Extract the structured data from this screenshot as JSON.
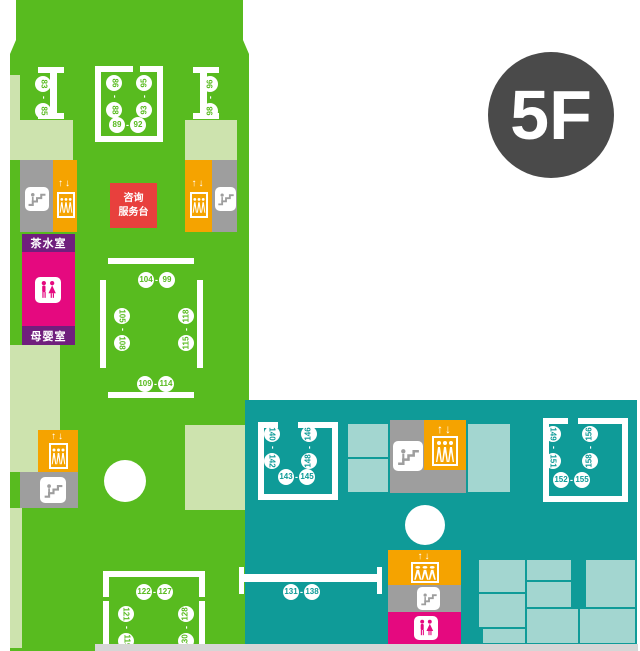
{
  "floor": {
    "badge": "5F"
  },
  "sep": "-",
  "elevator_arrows": "↑↓",
  "info_desk": {
    "line1": "咨询",
    "line2": "服务台"
  },
  "rooms": {
    "tea_room": "茶水室",
    "nursing_room": "母婴室"
  },
  "gates": {
    "pillar_left": {
      "a": "83",
      "b": "85"
    },
    "center_left": {
      "a": "86",
      "b": "88"
    },
    "center_bottom": {
      "a": "89",
      "b": "92"
    },
    "center_right": {
      "a": "95",
      "b": "93"
    },
    "pillar_right": {
      "a": "96",
      "b": "98"
    },
    "mid_top": {
      "a": "104",
      "b": "99"
    },
    "mid_left": {
      "a": "105",
      "b": "108"
    },
    "mid_bottom": {
      "a": "109",
      "b": "114"
    },
    "mid_right": {
      "a": "118",
      "b": "115"
    },
    "low_left": {
      "a": "121",
      "b": "119"
    },
    "low_top": {
      "a": "122",
      "b": "127"
    },
    "low_right": {
      "a": "128",
      "b": "130"
    },
    "teal_counter": {
      "a": "131",
      "b": "138"
    },
    "tl_left": {
      "a": "140",
      "b": "142"
    },
    "tl_bottom": {
      "a": "143",
      "b": "145"
    },
    "tl_right": {
      "a": "146",
      "b": "148"
    },
    "tr_left": {
      "a": "149",
      "b": "151"
    },
    "tr_bottom": {
      "a": "152",
      "b": "155"
    },
    "tr_right": {
      "a": "156",
      "b": "158"
    }
  },
  "colors": {
    "green": "#58bb1f",
    "pale_green": "#cde3ae",
    "teal": "#0f9b98",
    "pale_teal": "#a3d6d0",
    "orange": "#f5a300",
    "gray": "#9e9e9e",
    "magenta": "#e5097f",
    "purple": "#701f7d",
    "red": "#e8403d",
    "badge_gray": "#4a4a4a",
    "bottom_strip": "#d6d6d6"
  }
}
